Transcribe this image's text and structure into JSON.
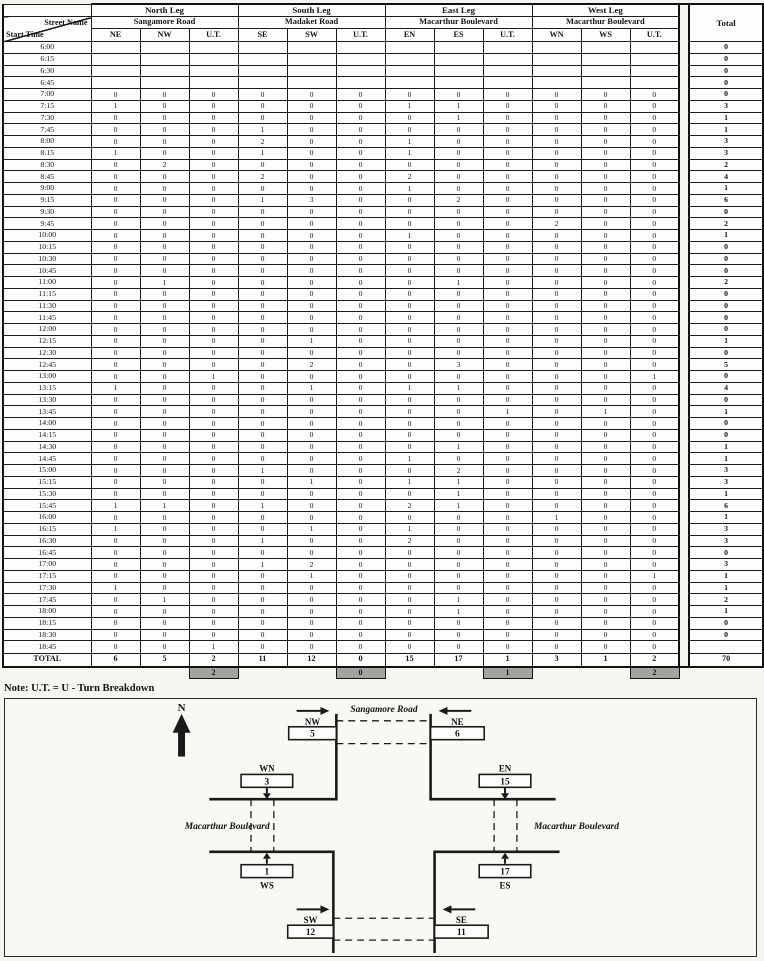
{
  "table": {
    "corner": {
      "top": "Street Name",
      "bottom": "Start Time"
    },
    "legs": [
      {
        "name": "North Leg",
        "street": "Sangamore Road",
        "movements": [
          "NE",
          "NW",
          "U.T."
        ]
      },
      {
        "name": "South Leg",
        "street": "Madaket Road",
        "movements": [
          "SE",
          "SW",
          "U.T."
        ]
      },
      {
        "name": "East Leg",
        "street": "Macarthur Boulevard",
        "movements": [
          "EN",
          "ES",
          "U.T."
        ]
      },
      {
        "name": "West Leg",
        "street": "Macarthur Boulevard",
        "movements": [
          "WN",
          "WS",
          "U.T."
        ]
      }
    ],
    "total_header": "Total",
    "rows": [
      {
        "time": "6:00",
        "values": [
          "",
          "",
          "",
          "",
          "",
          "",
          "",
          "",
          "",
          "",
          "",
          ""
        ],
        "total": "0"
      },
      {
        "time": "6:15",
        "values": [
          "",
          "",
          "",
          "",
          "",
          "",
          "",
          "",
          "",
          "",
          "",
          ""
        ],
        "total": "0"
      },
      {
        "time": "6:30",
        "values": [
          "",
          "",
          "",
          "",
          "",
          "",
          "",
          "",
          "",
          "",
          "",
          ""
        ],
        "total": "0"
      },
      {
        "time": "6:45",
        "values": [
          "",
          "",
          "",
          "",
          "",
          "",
          "",
          "",
          "",
          "",
          "",
          ""
        ],
        "total": "0"
      },
      {
        "time": "7:00",
        "values": [
          "0",
          "0",
          "0",
          "0",
          "0",
          "0",
          "0",
          "0",
          "0",
          "0",
          "0",
          "0"
        ],
        "total": "0"
      },
      {
        "time": "7:15",
        "values": [
          "1",
          "0",
          "0",
          "0",
          "0",
          "0",
          "1",
          "1",
          "0",
          "0",
          "0",
          "0"
        ],
        "total": "3"
      },
      {
        "time": "7:30",
        "values": [
          "0",
          "0",
          "0",
          "0",
          "0",
          "0",
          "0",
          "1",
          "0",
          "0",
          "0",
          "0"
        ],
        "total": "1"
      },
      {
        "time": "7:45",
        "values": [
          "0",
          "0",
          "0",
          "1",
          "0",
          "0",
          "0",
          "0",
          "0",
          "0",
          "0",
          "0"
        ],
        "total": "1"
      },
      {
        "time": "8:00",
        "values": [
          "0",
          "0",
          "0",
          "2",
          "0",
          "0",
          "1",
          "0",
          "0",
          "0",
          "0",
          "0"
        ],
        "total": "3"
      },
      {
        "time": "8:15",
        "values": [
          "1",
          "0",
          "0",
          "1",
          "0",
          "0",
          "1",
          "0",
          "0",
          "0",
          "0",
          "0"
        ],
        "total": "3"
      },
      {
        "time": "8:30",
        "values": [
          "0",
          "2",
          "0",
          "0",
          "0",
          "0",
          "0",
          "0",
          "0",
          "0",
          "0",
          "0"
        ],
        "total": "2"
      },
      {
        "time": "8:45",
        "values": [
          "0",
          "0",
          "0",
          "2",
          "0",
          "0",
          "2",
          "0",
          "0",
          "0",
          "0",
          "0"
        ],
        "total": "4"
      },
      {
        "time": "9:00",
        "values": [
          "0",
          "0",
          "0",
          "0",
          "0",
          "0",
          "1",
          "0",
          "0",
          "0",
          "0",
          "0"
        ],
        "total": "1"
      },
      {
        "time": "9:15",
        "values": [
          "0",
          "0",
          "0",
          "1",
          "3",
          "0",
          "0",
          "2",
          "0",
          "0",
          "0",
          "0"
        ],
        "total": "6"
      },
      {
        "time": "9:30",
        "values": [
          "0",
          "0",
          "0",
          "0",
          "0",
          "0",
          "0",
          "0",
          "0",
          "0",
          "0",
          "0"
        ],
        "total": "0"
      },
      {
        "time": "9:45",
        "values": [
          "0",
          "0",
          "0",
          "0",
          "0",
          "0",
          "0",
          "0",
          "0",
          "2",
          "0",
          "0"
        ],
        "total": "2"
      },
      {
        "time": "10:00",
        "values": [
          "0",
          "0",
          "0",
          "0",
          "0",
          "0",
          "1",
          "0",
          "0",
          "0",
          "0",
          "0"
        ],
        "total": "1"
      },
      {
        "time": "10:15",
        "values": [
          "0",
          "0",
          "0",
          "0",
          "0",
          "0",
          "0",
          "0",
          "0",
          "0",
          "0",
          "0"
        ],
        "total": "0"
      },
      {
        "time": "10:30",
        "values": [
          "0",
          "0",
          "0",
          "0",
          "0",
          "0",
          "0",
          "0",
          "0",
          "0",
          "0",
          "0"
        ],
        "total": "0"
      },
      {
        "time": "10:45",
        "values": [
          "0",
          "0",
          "0",
          "0",
          "0",
          "0",
          "0",
          "0",
          "0",
          "0",
          "0",
          "0"
        ],
        "total": "0"
      },
      {
        "time": "11:00",
        "values": [
          "0",
          "1",
          "0",
          "0",
          "0",
          "0",
          "0",
          "1",
          "0",
          "0",
          "0",
          "0"
        ],
        "total": "2"
      },
      {
        "time": "11:15",
        "values": [
          "0",
          "0",
          "0",
          "0",
          "0",
          "0",
          "0",
          "0",
          "0",
          "0",
          "0",
          "0"
        ],
        "total": "0"
      },
      {
        "time": "11:30",
        "values": [
          "0",
          "0",
          "0",
          "0",
          "0",
          "0",
          "0",
          "0",
          "0",
          "0",
          "0",
          "0"
        ],
        "total": "0"
      },
      {
        "time": "11:45",
        "values": [
          "0",
          "0",
          "0",
          "0",
          "0",
          "0",
          "0",
          "0",
          "0",
          "0",
          "0",
          "0"
        ],
        "total": "0"
      },
      {
        "time": "12:00",
        "values": [
          "0",
          "0",
          "0",
          "0",
          "0",
          "0",
          "0",
          "0",
          "0",
          "0",
          "0",
          "0"
        ],
        "total": "0"
      },
      {
        "time": "12:15",
        "values": [
          "0",
          "0",
          "0",
          "0",
          "1",
          "0",
          "0",
          "0",
          "0",
          "0",
          "0",
          "0"
        ],
        "total": "1"
      },
      {
        "time": "12:30",
        "values": [
          "0",
          "0",
          "0",
          "0",
          "0",
          "0",
          "0",
          "0",
          "0",
          "0",
          "0",
          "0"
        ],
        "total": "0"
      },
      {
        "time": "12:45",
        "values": [
          "0",
          "0",
          "0",
          "0",
          "2",
          "0",
          "0",
          "3",
          "0",
          "0",
          "0",
          "0"
        ],
        "total": "5"
      },
      {
        "time": "13:00",
        "values": [
          "0",
          "0",
          "1",
          "0",
          "0",
          "0",
          "0",
          "0",
          "0",
          "0",
          "0",
          "1"
        ],
        "total": "0"
      },
      {
        "time": "13:15",
        "values": [
          "1",
          "0",
          "0",
          "0",
          "1",
          "0",
          "1",
          "1",
          "0",
          "0",
          "0",
          "0"
        ],
        "total": "4"
      },
      {
        "time": "13:30",
        "values": [
          "0",
          "0",
          "0",
          "0",
          "0",
          "0",
          "0",
          "0",
          "0",
          "0",
          "0",
          "0"
        ],
        "total": "0"
      },
      {
        "time": "13:45",
        "values": [
          "0",
          "0",
          "0",
          "0",
          "0",
          "0",
          "0",
          "0",
          "1",
          "0",
          "1",
          "0"
        ],
        "total": "1"
      },
      {
        "time": "14:00",
        "values": [
          "0",
          "0",
          "0",
          "0",
          "0",
          "0",
          "0",
          "0",
          "0",
          "0",
          "0",
          "0"
        ],
        "total": "0"
      },
      {
        "time": "14:15",
        "values": [
          "0",
          "0",
          "0",
          "0",
          "0",
          "0",
          "0",
          "0",
          "0",
          "0",
          "0",
          "0"
        ],
        "total": "0"
      },
      {
        "time": "14:30",
        "values": [
          "0",
          "0",
          "0",
          "0",
          "0",
          "0",
          "0",
          "1",
          "0",
          "0",
          "0",
          "0"
        ],
        "total": "1"
      },
      {
        "time": "14:45",
        "values": [
          "0",
          "0",
          "0",
          "0",
          "0",
          "0",
          "1",
          "0",
          "0",
          "0",
          "0",
          "0"
        ],
        "total": "1"
      },
      {
        "time": "15:00",
        "values": [
          "0",
          "0",
          "0",
          "1",
          "0",
          "0",
          "0",
          "2",
          "0",
          "0",
          "0",
          "0"
        ],
        "total": "3"
      },
      {
        "time": "15:15",
        "values": [
          "0",
          "0",
          "0",
          "0",
          "1",
          "0",
          "1",
          "1",
          "0",
          "0",
          "0",
          "0"
        ],
        "total": "3"
      },
      {
        "time": "15:30",
        "values": [
          "0",
          "0",
          "0",
          "0",
          "0",
          "0",
          "0",
          "1",
          "0",
          "0",
          "0",
          "0"
        ],
        "total": "1"
      },
      {
        "time": "15:45",
        "values": [
          "1",
          "1",
          "0",
          "1",
          "0",
          "0",
          "2",
          "1",
          "0",
          "0",
          "0",
          "0"
        ],
        "total": "6"
      },
      {
        "time": "16:00",
        "values": [
          "0",
          "0",
          "0",
          "0",
          "0",
          "0",
          "0",
          "0",
          "0",
          "1",
          "0",
          "0"
        ],
        "total": "1"
      },
      {
        "time": "16:15",
        "values": [
          "1",
          "0",
          "0",
          "0",
          "1",
          "0",
          "1",
          "0",
          "0",
          "0",
          "0",
          "0"
        ],
        "total": "3"
      },
      {
        "time": "16:30",
        "values": [
          "0",
          "0",
          "0",
          "1",
          "0",
          "0",
          "2",
          "0",
          "0",
          "0",
          "0",
          "0"
        ],
        "total": "3"
      },
      {
        "time": "16:45",
        "values": [
          "0",
          "0",
          "0",
          "0",
          "0",
          "0",
          "0",
          "0",
          "0",
          "0",
          "0",
          "0"
        ],
        "total": "0"
      },
      {
        "time": "17:00",
        "values": [
          "0",
          "0",
          "0",
          "1",
          "2",
          "0",
          "0",
          "0",
          "0",
          "0",
          "0",
          "0"
        ],
        "total": "3"
      },
      {
        "time": "17:15",
        "values": [
          "0",
          "0",
          "0",
          "0",
          "1",
          "0",
          "0",
          "0",
          "0",
          "0",
          "0",
          "1"
        ],
        "total": "1"
      },
      {
        "time": "17:30",
        "values": [
          "1",
          "0",
          "0",
          "0",
          "0",
          "0",
          "0",
          "0",
          "0",
          "0",
          "0",
          "0"
        ],
        "total": "1"
      },
      {
        "time": "17:45",
        "values": [
          "0",
          "1",
          "0",
          "0",
          "0",
          "0",
          "0",
          "1",
          "0",
          "0",
          "0",
          "0"
        ],
        "total": "2"
      },
      {
        "time": "18:00",
        "values": [
          "0",
          "0",
          "0",
          "0",
          "0",
          "0",
          "0",
          "1",
          "0",
          "0",
          "0",
          "0"
        ],
        "total": "1"
      },
      {
        "time": "18:15",
        "values": [
          "0",
          "0",
          "0",
          "0",
          "0",
          "0",
          "0",
          "0",
          "0",
          "0",
          "0",
          "0"
        ],
        "total": "0"
      },
      {
        "time": "18:30",
        "values": [
          "0",
          "0",
          "0",
          "0",
          "0",
          "0",
          "0",
          "0",
          "0",
          "0",
          "0",
          "0"
        ],
        "total": "0"
      },
      {
        "time": "18:45",
        "values": [
          "0",
          "0",
          "1",
          "0",
          "0",
          "0",
          "0",
          "0",
          "0",
          "0",
          "0",
          "0"
        ],
        "total": ""
      }
    ],
    "total_row": {
      "label": "TOTAL",
      "values": [
        "6",
        "5",
        "2",
        "11",
        "12",
        "0",
        "15",
        "17",
        "1",
        "3",
        "1",
        "2"
      ],
      "total": "70"
    },
    "ut_breakdown": [
      "2",
      "0",
      "1",
      "2"
    ]
  },
  "note": "Note: U.T. = U - Turn Breakdown",
  "diagram": {
    "compass": "N",
    "north_street": "Sangamore Road",
    "west_street": "Macarthur Boulevard",
    "east_street": "Macarthur Boulevard",
    "codes": {
      "NW": "NW",
      "NE": "NE",
      "WN": "WN",
      "EN": "EN",
      "WS": "WS",
      "ES": "ES",
      "SW": "SW",
      "SE": "SE"
    },
    "counts": {
      "NW": "5",
      "NE": "6",
      "WN": "3",
      "EN": "15",
      "WS": "1",
      "ES": "17",
      "SW": "12",
      "SE": "11"
    }
  },
  "colors": {
    "grid": "#1b1b1b",
    "ut_gray": "#a3a3a0",
    "paper": "#f6f5f1"
  }
}
